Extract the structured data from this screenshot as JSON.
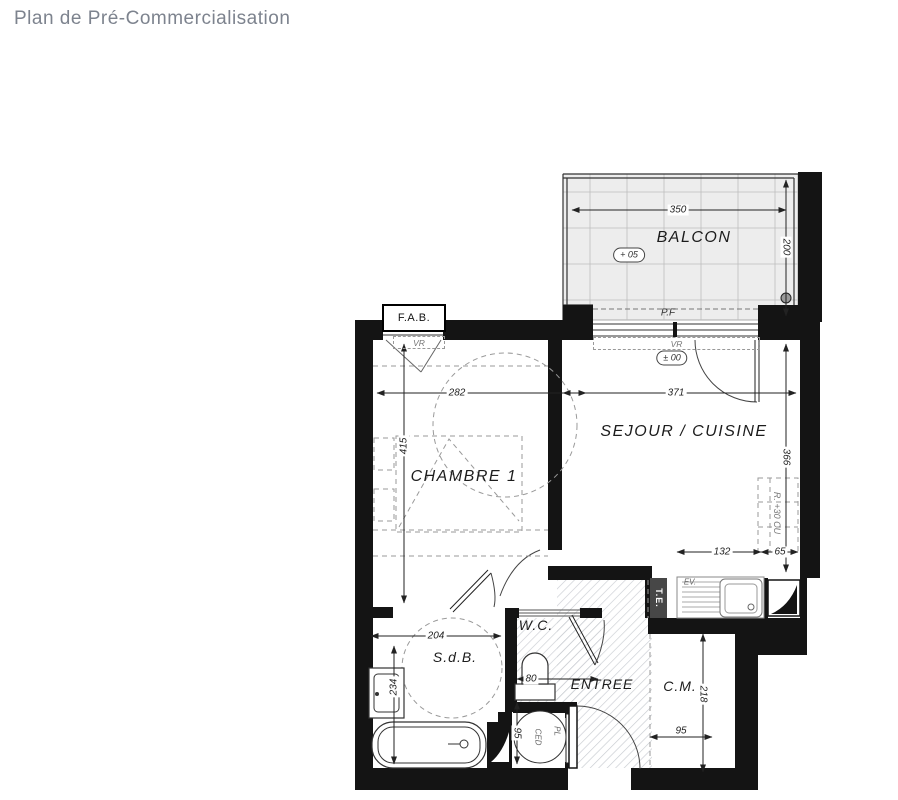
{
  "title": "Plan de Pré-Commercialisation",
  "rooms": {
    "balcony": "BALCON",
    "living_kitchen": "SEJOUR / CUISINE",
    "bedroom": "CHAMBRE 1",
    "bathroom": "S.d.B.",
    "wc": "W.C.",
    "entrance": "ENTREE",
    "closet": "C.M."
  },
  "annotations": {
    "fab": "F.A.B.",
    "pf": "P.F",
    "vr_bedroom": "VR",
    "vr_living": "VR",
    "level_balcony": "+ 05",
    "level_living": "± 00",
    "electrical_panel": "T.E.",
    "kitchen_sink": "EV.",
    "fridge_unit": "R. +30 CU",
    "water_heater": "CED",
    "placard": "PL"
  },
  "dimensions": {
    "balcony_width": "350",
    "balcony_depth": "200",
    "bedroom_width": "282",
    "living_width": "371",
    "bedroom_depth": "415",
    "living_depth": "366",
    "kitchen_run": "132",
    "kitchen_side": "65",
    "bathroom_width": "204",
    "bathroom_depth": "234",
    "wc_width": "80",
    "wc_depth": "95",
    "closet_depth": "218",
    "closet_width": "95"
  },
  "colors": {
    "wall": "#141414",
    "balcony_fill": "#ededed",
    "hatch": "#c9ccd1",
    "panel_fill": "#474747"
  }
}
